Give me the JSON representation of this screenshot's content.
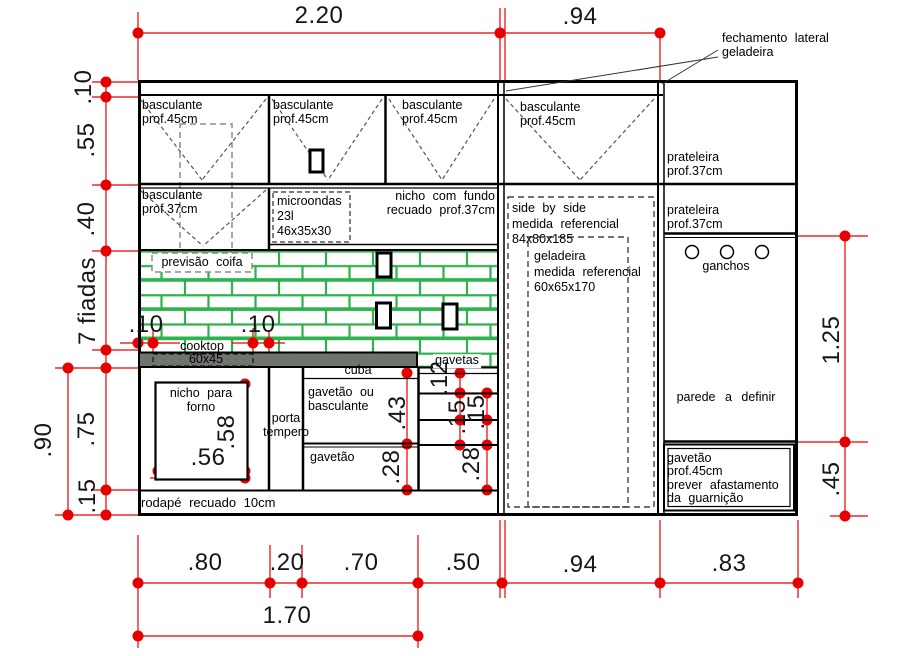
{
  "colors": {
    "dimension_red": "#e60000",
    "tile_green": "#2eb34c",
    "counter_gray": "#6f746f",
    "line_black": "#000000"
  },
  "wall_cabinets": {
    "doors_45": [
      {
        "line1": "basculante",
        "line2": "prof.45cm"
      },
      {
        "line1": "basculante",
        "line2": "prof.45cm"
      },
      {
        "line1": "basculante",
        "line2": "prof.45cm"
      },
      {
        "line1": "basculante",
        "line2": "prof.45cm"
      }
    ],
    "door_37": {
      "line1": "basculante",
      "line2": "prof.37cm"
    },
    "microwave": {
      "line1": "microondas",
      "line2": "23l",
      "line3": "46x35x30"
    },
    "niche": {
      "line1": "nicho com fundo",
      "line2": "recuado prof.37cm"
    },
    "hood_note": "previsão coifa"
  },
  "fridge": {
    "closure_note": {
      "line1": "fechamento lateral",
      "line2": "geladeira"
    },
    "side_by_side": {
      "line1": "side by side",
      "line2": "medida referencial",
      "line3": "84x80x185"
    },
    "geladeira": {
      "line1": "geladeira",
      "line2": "medida referencial",
      "line3": "60x65x170"
    }
  },
  "right_column": {
    "shelf_top": {
      "line1": "prateleira",
      "line2": "prof.37cm"
    },
    "shelf_mid": {
      "line1": "prateleira",
      "line2": "prof.37cm"
    },
    "hooks": "ganchos",
    "wall_note": "parede a definir",
    "drawer": {
      "line1": "gavetão",
      "line2": "prof.45cm",
      "line3": "prever afastamento",
      "line4": "da guarnição"
    }
  },
  "counter": {
    "cooktop": "cooktop",
    "cooktop_size": "60x45",
    "sink": "cuba",
    "drawers_label": "gavetas",
    "clearance_left": ".10",
    "clearance_right": ".10"
  },
  "base_cabinets": {
    "oven_niche": {
      "line1": "nicho para",
      "line2": "forno",
      "width": ".56",
      "height": ".58"
    },
    "spice_door": {
      "line1": "porta",
      "line2": "tempero"
    },
    "big_drawer_top": {
      "line1": "gavetão ou",
      "line2": "basculante",
      "height": ".43"
    },
    "big_drawer_bottom": {
      "label": "gavetão",
      "height": ".28"
    },
    "drawer_stack_heights": [
      ".12",
      ".15",
      ".15",
      ".28"
    ],
    "toe_kick": "rodapé recuado 10cm"
  },
  "dimensions": {
    "top": [
      "2.20",
      ".94"
    ],
    "left": [
      ".10",
      ".55",
      ".40"
    ],
    "tile_rows": "7 fiadas",
    "left_lower": {
      "total": ".90",
      "upper": ".75",
      "toe": ".15"
    },
    "right": {
      "upper": "1.25",
      "lower": ".45"
    },
    "bottom": [
      ".80",
      ".20",
      ".70",
      ".50",
      ".94",
      ".83"
    ],
    "bottom_total": "1.70"
  }
}
